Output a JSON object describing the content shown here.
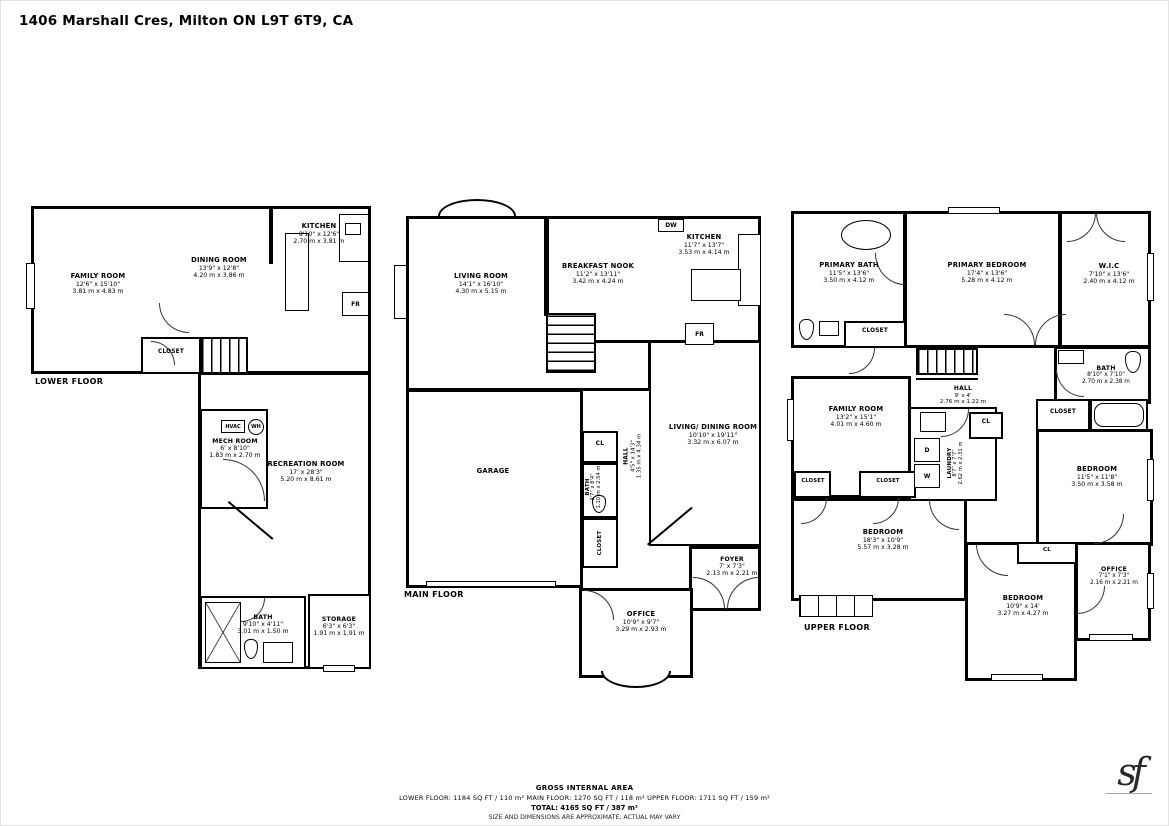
{
  "title": "1406 Marshall Cres, Milton ON L9T 6T9, CA",
  "floors": {
    "lower": {
      "label": "LOWER FLOOR",
      "rooms": [
        {
          "name": "FAMILY ROOM",
          "ft": "12'6\" x 15'10\"",
          "m": "3.81 m x 4.83 m"
        },
        {
          "name": "DINING ROOM",
          "ft": "13'9\" x 12'8\"",
          "m": "4.20 m x 3.86 m"
        },
        {
          "name": "KITCHEN",
          "ft": "8'10\" x 12'6\"",
          "m": "2.70 m x 3.81 m"
        },
        {
          "name": "CLOSET"
        },
        {
          "name": "MECH ROOM",
          "ft": "6' x 8'10\"",
          "m": "1.83 m x 2.70 m"
        },
        {
          "name": "RECREATION ROOM",
          "ft": "17' x 28'3\"",
          "m": "5.20 m x 8.61 m"
        },
        {
          "name": "BATH",
          "ft": "9'10\" x 4'11\"",
          "m": "3.01 m x 1.50 m"
        },
        {
          "name": "STORAGE",
          "ft": "6'3\" x 6'3\"",
          "m": "1.91 m x 1.91 m"
        }
      ],
      "appliances": {
        "hvac": "HVAC",
        "wh": "WH",
        "fr": "FR"
      }
    },
    "main": {
      "label": "MAIN FLOOR",
      "rooms": [
        {
          "name": "LIVING ROOM",
          "ft": "14'1\" x 16'10\"",
          "m": "4.30 m x 5.15 m"
        },
        {
          "name": "BREAKFAST NOOK",
          "ft": "11'2\" x 13'11\"",
          "m": "3.42 m x 4.24 m"
        },
        {
          "name": "KITCHEN",
          "ft": "11'7\" x 13'7\"",
          "m": "3.53 m x 4.14 m"
        },
        {
          "name": "GARAGE"
        },
        {
          "name": "LIVING/ DINING ROOM",
          "ft": "10'10\" x 19'11\"",
          "m": "3.32 m x 6.07 m"
        },
        {
          "name": "HALL",
          "ft": "4'5\" x 14'3\"",
          "m": "1.35 m x 4.34 m"
        },
        {
          "name": "BATH",
          "ft": "3'7\" x 8'4\"",
          "m": "1.10 m x 2.54 m"
        },
        {
          "name": "FOYER",
          "ft": "7' x 7'3\"",
          "m": "2.13 m x 2.21 m"
        },
        {
          "name": "OFFICE",
          "ft": "10'9\" x 9'7\"",
          "m": "3.29 m x 2.93 m"
        },
        {
          "name": "CL"
        },
        {
          "name": "CLOSET"
        }
      ],
      "appliances": {
        "dw": "DW",
        "fr": "FR"
      }
    },
    "upper": {
      "label": "UPPER FLOOR",
      "rooms": [
        {
          "name": "PRIMARY BATH",
          "ft": "11'5\" x 13'6\"",
          "m": "3.50 m x 4.12 m"
        },
        {
          "name": "PRIMARY BEDROOM",
          "ft": "17'4\" x 13'6\"",
          "m": "5.28 m x 4.12 m"
        },
        {
          "name": "W.I.C",
          "ft": "7'10\" x 13'6\"",
          "m": "2.40 m x 4.12 m"
        },
        {
          "name": "CLOSET"
        },
        {
          "name": "HALL",
          "ft": "9' x 4'",
          "m": "2.76 m x 1.22 m"
        },
        {
          "name": "BATH",
          "ft": "8'10\" x 7'10\"",
          "m": "2.70 m x 2.38 m"
        },
        {
          "name": "FAMILY ROOM",
          "ft": "13'2\" x 15'1\"",
          "m": "4.01 m x 4.60 m"
        },
        {
          "name": "LAUNDRY",
          "ft": "8'7\" x 7'7\"",
          "m": "2.62 m x 2.31 m"
        },
        {
          "name": "CLOSET"
        },
        {
          "name": "CLOSET"
        },
        {
          "name": "BEDROOM",
          "ft": "18'3\" x 10'9\"",
          "m": "5.57 m x 3.28 m"
        },
        {
          "name": "BEDROOM",
          "ft": "11'5\" x 11'8\"",
          "m": "3.50 m x 3.58 m"
        },
        {
          "name": "CLOSET"
        },
        {
          "name": "BEDROOM",
          "ft": "10'9\" x 14'",
          "m": "3.27 m x 4.27 m"
        },
        {
          "name": "OFFICE",
          "ft": "7'1\" x 7'3\"",
          "m": "2.16 m x 2.21 m"
        }
      ],
      "appliances": {
        "w": "W",
        "d": "D",
        "cl": "CL"
      }
    }
  },
  "footer": {
    "heading": "GROSS INTERNAL AREA",
    "breakdown": "LOWER FLOOR: 1184 SQ FT / 110 m²   MAIN FLOOR: 1270 SQ FT / 118 m²   UPPER FLOOR: 1711 SQ FT / 159 m²",
    "total": "TOTAL: 4165 SQ FT / 387 m²",
    "disclaimer": "SIZE AND DIMENSIONS ARE APPROXIMATE, ACTUAL MAY VARY"
  },
  "logo": {
    "monogram": "sf"
  }
}
